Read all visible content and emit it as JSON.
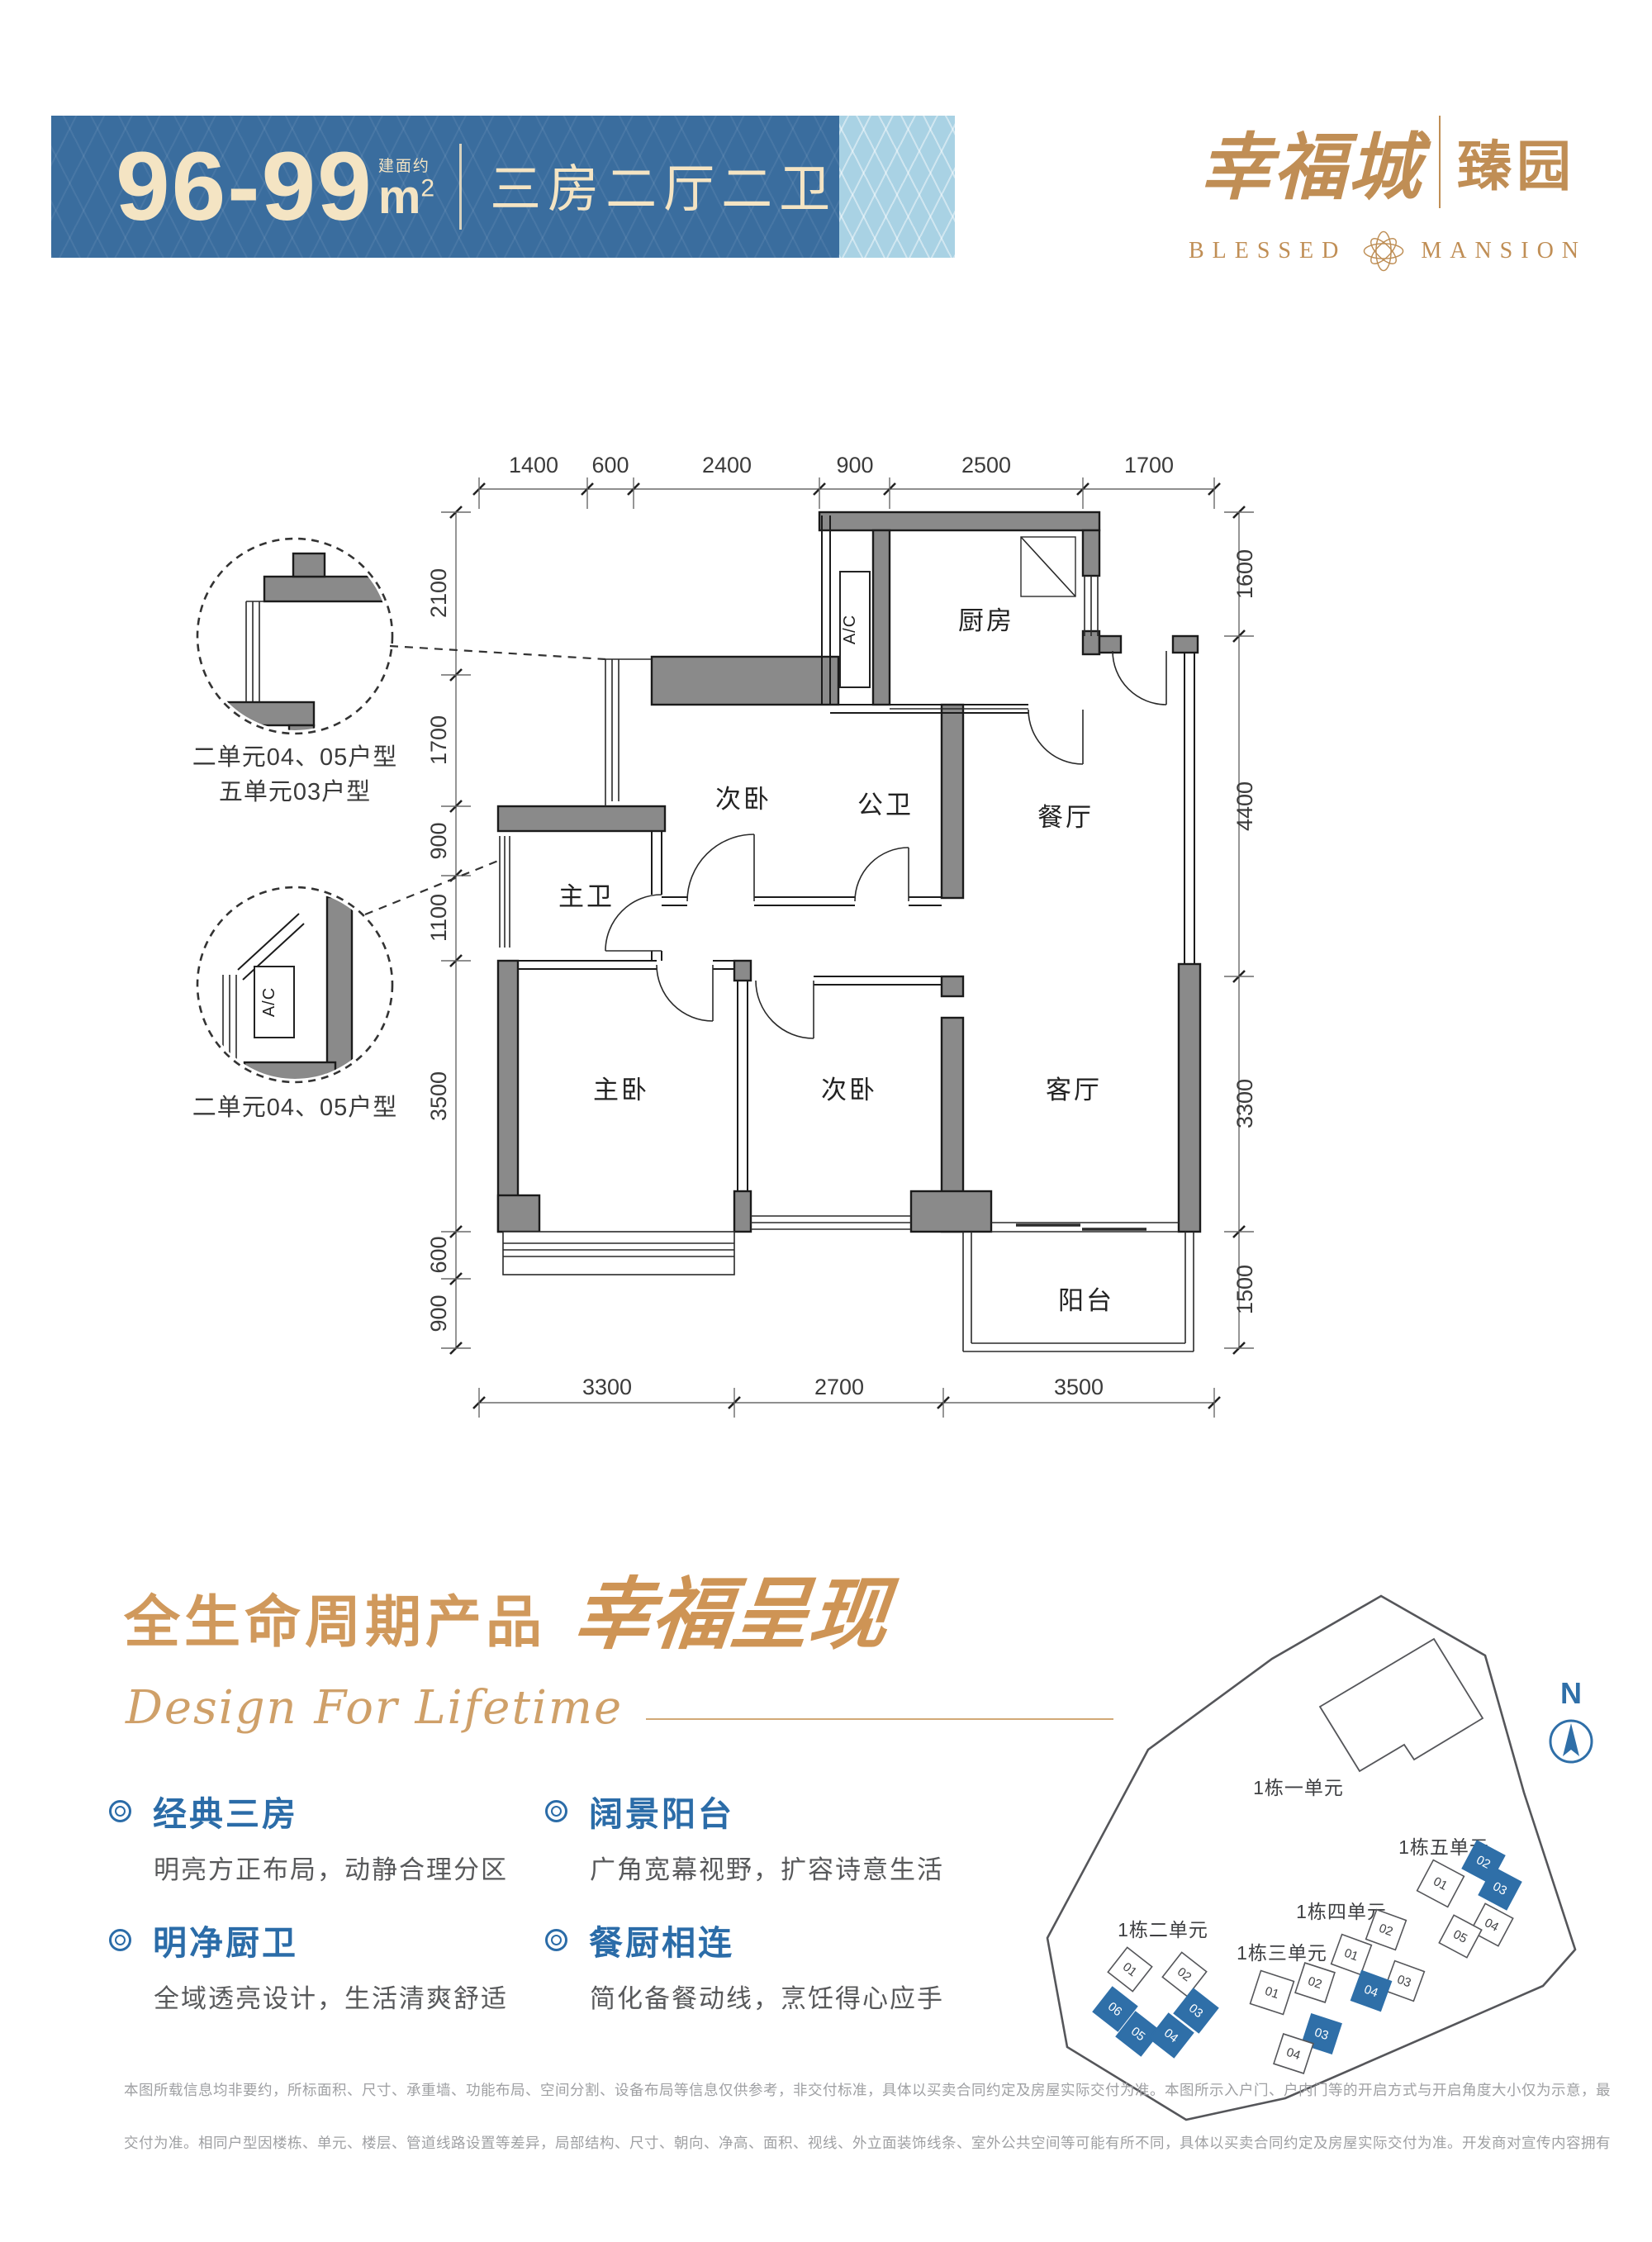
{
  "banner": {
    "area": "96-99",
    "area_prefix": "建面约",
    "unit": "m",
    "unit_sup": "2",
    "layout": "三房二厅二卫"
  },
  "logo": {
    "cn_main": "幸福城",
    "cn_sub": "臻园",
    "en_left": "BLESSED",
    "en_right": "MANSION"
  },
  "floorplan": {
    "dims_top": [
      "1400",
      "600",
      "2400",
      "900",
      "2500",
      "1700"
    ],
    "dims_bottom": [
      "3300",
      "2700",
      "3500"
    ],
    "dims_left": [
      "2100",
      "1700",
      "900",
      "1100",
      "3500",
      "600",
      "900"
    ],
    "dims_right": [
      "1600",
      "4400",
      "3300",
      "1500"
    ],
    "rooms": {
      "kitchen": "厨房",
      "dining": "餐厅",
      "bed2_top": "次卧",
      "bath_public": "公卫",
      "bath_master": "主卫",
      "bed_master": "主卧",
      "bed2_bottom": "次卧",
      "living": "客厅",
      "balcony": "阳台"
    },
    "ac_label": "A/C",
    "callout1_line1": "二单元04、05户型",
    "callout1_line2": "五单元03户型",
    "callout2_line1": "二单元04、05户型"
  },
  "section": {
    "title": "全生命周期产品",
    "script": "幸福呈现",
    "subtitle": "Design For Lifetime",
    "features": [
      {
        "title": "经典三房",
        "desc": "明亮方正布局，动静合理分区"
      },
      {
        "title": "明净厨卫",
        "desc": "全域透亮设计，生活清爽舒适"
      },
      {
        "title": "阔景阳台",
        "desc": "广角宽幕视野，扩容诗意生活"
      },
      {
        "title": "餐厨相连",
        "desc": "简化备餐动线，烹饪得心应手"
      }
    ]
  },
  "siteplan": {
    "compass": "N",
    "b1_label": "1栋一单元",
    "b2_label": "1栋二单元",
    "b3_label": "1栋三单元",
    "b4_label": "1栋四单元",
    "b5_label": "1栋五单元",
    "b2_units": [
      {
        "no": "01",
        "hl": false
      },
      {
        "no": "02",
        "hl": false
      },
      {
        "no": "06",
        "hl": true
      },
      {
        "no": "05",
        "hl": true
      },
      {
        "no": "04",
        "hl": true
      },
      {
        "no": "03",
        "hl": true
      }
    ],
    "b3_units": [
      {
        "no": "01",
        "hl": false
      },
      {
        "no": "02",
        "hl": false
      },
      {
        "no": "03",
        "hl": true
      },
      {
        "no": "04",
        "hl": false
      }
    ],
    "b4_units": [
      {
        "no": "01",
        "hl": false
      },
      {
        "no": "02",
        "hl": false
      },
      {
        "no": "03",
        "hl": false
      },
      {
        "no": "04",
        "hl": true
      }
    ],
    "b5_units": [
      {
        "no": "01",
        "hl": false
      },
      {
        "no": "02",
        "hl": true
      },
      {
        "no": "03",
        "hl": true
      },
      {
        "no": "04",
        "hl": false
      },
      {
        "no": "05",
        "hl": false
      }
    ]
  },
  "disclaimer": {
    "line1": "本图所载信息均非要约，所标面积、尺寸、承重墙、功能布局、空间分割、设备布局等信息仅供参考，非交付标准，具体以买卖合同约定及房屋实际交付为准。本图所示入户门、户内门等的开启方式与开启角度大小仅为示意，最终以房屋实际",
    "line2": "交付为准。相同户型因楼栋、单元、楼层、管道线路设置等差异，局部结构、尺寸、朝向、净高、面积、视线、外立面装饰线条、室外公共空间等可能有所不同，具体以买卖合同约定及房屋实际交付为准。开发商对宣传内容拥有最终解释权。"
  },
  "colors": {
    "banner-blue": "#3A6D9E",
    "banner-panel": "#A9D2E4",
    "cream": "#F4E4C3",
    "gold": "#C08E55",
    "gold-light": "#D0995C",
    "feature-blue": "#2B6CA8",
    "text-gray": "#58595B",
    "disc-gray": "#9FA0A3",
    "wall-gray": "#8A8A8A",
    "line-dark": "#1B1B1B",
    "site-blue": "#2F6FA8"
  }
}
